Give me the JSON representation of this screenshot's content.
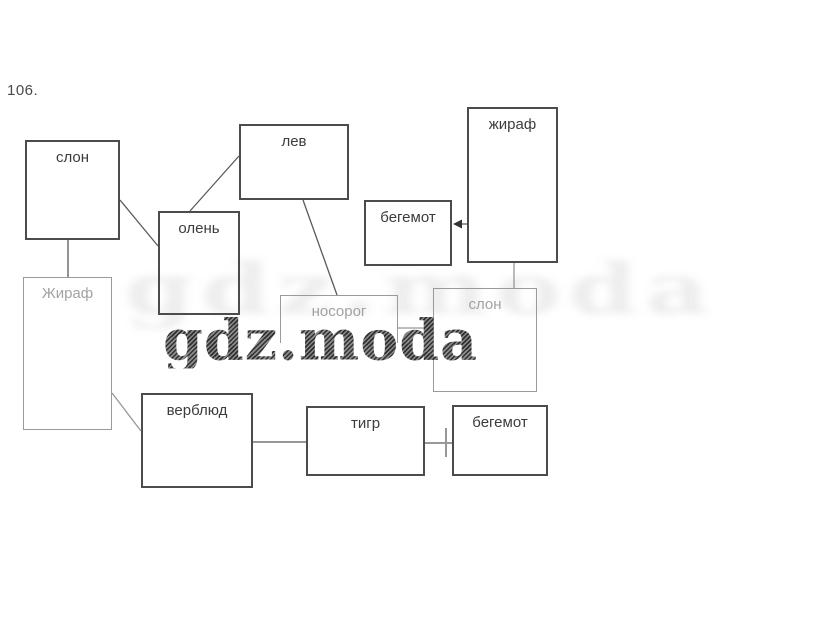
{
  "page": {
    "label": "106."
  },
  "watermark": {
    "text": "gdz.moda",
    "dark_color": "#474747",
    "faint_color": "rgba(60,60,60,0.09)"
  },
  "diagram": {
    "line_color_dark": "#5a5a5a",
    "line_color_light": "#979797",
    "boxes": [
      {
        "id": "slon-1",
        "label": "слон",
        "x": 25,
        "y": 140,
        "w": 95,
        "h": 100,
        "faded": false,
        "noBottom": false
      },
      {
        "id": "lev",
        "label": "лев",
        "x": 239,
        "y": 124,
        "w": 110,
        "h": 76,
        "faded": false,
        "noBottom": false
      },
      {
        "id": "zhiraf-1",
        "label": "жираф",
        "x": 467,
        "y": 107,
        "w": 91,
        "h": 156,
        "faded": false,
        "noBottom": false
      },
      {
        "id": "begemot-1",
        "label": "бегемот",
        "x": 364,
        "y": 200,
        "w": 88,
        "h": 66,
        "faded": false,
        "noBottom": false
      },
      {
        "id": "olen",
        "label": "олень",
        "x": 158,
        "y": 211,
        "w": 82,
        "h": 104,
        "faded": false,
        "noBottom": false
      },
      {
        "id": "zhiraf-2",
        "label": "Жираф",
        "x": 23,
        "y": 277,
        "w": 89,
        "h": 153,
        "faded": true,
        "noBottom": false
      },
      {
        "id": "nosorog",
        "label": "носорог",
        "x": 280,
        "y": 295,
        "w": 118,
        "h": 48,
        "faded": true,
        "noBottom": true
      },
      {
        "id": "slon-2",
        "label": "слон",
        "x": 433,
        "y": 288,
        "w": 104,
        "h": 104,
        "faded": true,
        "noBottom": false
      },
      {
        "id": "verblyud",
        "label": "верблюд",
        "x": 141,
        "y": 393,
        "w": 112,
        "h": 95,
        "faded": false,
        "noBottom": false
      },
      {
        "id": "tigr",
        "label": "тигр",
        "x": 306,
        "y": 406,
        "w": 119,
        "h": 70,
        "faded": false,
        "noBottom": false
      },
      {
        "id": "begemot-2",
        "label": "бегемот",
        "x": 452,
        "y": 405,
        "w": 96,
        "h": 71,
        "faded": false,
        "noBottom": false
      }
    ],
    "connectors": [
      {
        "id": "slon1-olen",
        "x1": 120,
        "y1": 200,
        "x2": 158,
        "y2": 246,
        "type": "line",
        "shade": "dark"
      },
      {
        "id": "olen-lev",
        "x1": 190,
        "y1": 211,
        "x2": 239,
        "y2": 156,
        "type": "line",
        "shade": "dark"
      },
      {
        "id": "lev-nosorog",
        "x1": 303,
        "y1": 200,
        "x2": 337,
        "y2": 295,
        "type": "line",
        "shade": "dark"
      },
      {
        "id": "slon1-zhiraf2",
        "x1": 68,
        "y1": 240,
        "x2": 68,
        "y2": 277,
        "type": "line",
        "shade": "dark"
      },
      {
        "id": "zhiraf1-begemot1",
        "x1": 467,
        "y1": 224,
        "x2": 456,
        "y2": 224,
        "type": "arrow",
        "shade": "dark",
        "tipX": 453,
        "tipY": 224
      },
      {
        "id": "zhiraf1-slon2",
        "x1": 514,
        "y1": 263,
        "x2": 514,
        "y2": 288,
        "type": "line",
        "shade": "light"
      },
      {
        "id": "nosorog-slon2",
        "x1": 398,
        "y1": 328,
        "x2": 433,
        "y2": 328,
        "type": "line",
        "shade": "light"
      },
      {
        "id": "zhiraf2-verblyud",
        "x1": 112,
        "y1": 393,
        "x2": 141,
        "y2": 431,
        "type": "line",
        "shade": "light"
      },
      {
        "id": "verblyud-tigr",
        "x1": 253,
        "y1": 442,
        "x2": 306,
        "y2": 442,
        "type": "line",
        "shade": "dark"
      },
      {
        "id": "tigr-begemot2",
        "x1": 425,
        "y1": 443,
        "x2": 452,
        "y2": 443,
        "type": "tick",
        "shade": "dark",
        "tickX": 446,
        "tickY1": 428,
        "tickY2": 457
      }
    ]
  }
}
